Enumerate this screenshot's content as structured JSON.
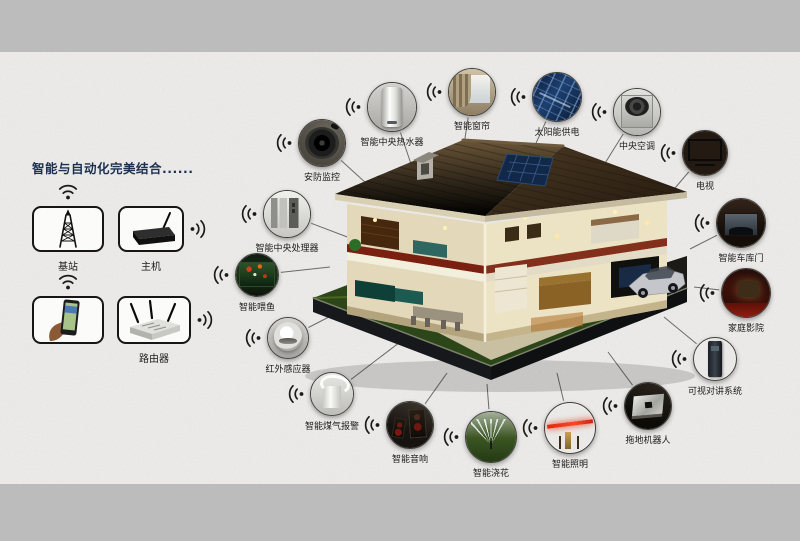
{
  "page": {
    "band_color": "#bcbcbc",
    "content_color": "#edecea",
    "title_color": "#1b3050"
  },
  "left_panel": {
    "title": "智能与自动化完美结合......",
    "items": [
      {
        "label": "基站",
        "icon": "cell-tower"
      },
      {
        "label": "主机",
        "icon": "host-box"
      },
      {
        "label": "",
        "icon": "phone-hand"
      },
      {
        "label": "路由器",
        "icon": "router"
      }
    ]
  },
  "house": {
    "description": "smart-home-cutaway-illustration"
  },
  "devices": [
    {
      "label": "安防监控",
      "icon": "security",
      "x": 322,
      "y": 143,
      "r": 24,
      "to": [
        390,
        205
      ]
    },
    {
      "label": "智能中央热水器",
      "icon": "water-heater",
      "x": 392,
      "y": 107,
      "r": 25,
      "to": [
        415,
        176
      ]
    },
    {
      "label": "智能窗帘",
      "icon": "curtain",
      "x": 472,
      "y": 92,
      "r": 24,
      "to": [
        462,
        158
      ]
    },
    {
      "label": "太阳能供电",
      "icon": "solar",
      "x": 557,
      "y": 97,
      "r": 25,
      "to": [
        527,
        163
      ]
    },
    {
      "label": "中央空调",
      "icon": "ac",
      "x": 637,
      "y": 112,
      "r": 24,
      "to": [
        592,
        184
      ]
    },
    {
      "label": "电视",
      "icon": "tv",
      "x": 705,
      "y": 153,
      "r": 23,
      "to": [
        657,
        209
      ]
    },
    {
      "label": "智能车库门",
      "icon": "garage",
      "x": 741,
      "y": 223,
      "r": 25,
      "to": [
        690,
        249
      ]
    },
    {
      "label": "家庭影院",
      "icon": "theater",
      "x": 746,
      "y": 293,
      "r": 25,
      "to": [
        694,
        287
      ]
    },
    {
      "label": "可视对讲系统",
      "icon": "intercom",
      "x": 715,
      "y": 359,
      "r": 22,
      "to": [
        664,
        317
      ]
    },
    {
      "label": "拖地机器人",
      "icon": "robot",
      "x": 648,
      "y": 406,
      "r": 24,
      "to": [
        608,
        352
      ]
    },
    {
      "label": "智能照明",
      "icon": "lighting",
      "x": 570,
      "y": 428,
      "r": 26,
      "to": [
        557,
        373
      ]
    },
    {
      "label": "智能浇花",
      "icon": "sprinkler",
      "x": 491,
      "y": 437,
      "r": 26,
      "to": [
        487,
        384
      ]
    },
    {
      "label": "智能音响",
      "icon": "speakers",
      "x": 410,
      "y": 425,
      "r": 24,
      "to": [
        447,
        373
      ]
    },
    {
      "label": "智能煤气报警",
      "icon": "gas",
      "x": 332,
      "y": 394,
      "r": 22,
      "to": [
        404,
        339
      ]
    },
    {
      "label": "红外感应器",
      "icon": "ir",
      "x": 288,
      "y": 338,
      "r": 21,
      "to": [
        356,
        303
      ]
    },
    {
      "label": "智能喂鱼",
      "icon": "fish",
      "x": 257,
      "y": 275,
      "r": 22,
      "to": [
        330,
        267
      ]
    },
    {
      "label": "智能中央处理器",
      "icon": "cpu",
      "x": 287,
      "y": 214,
      "r": 24,
      "to": [
        350,
        238
      ]
    }
  ]
}
